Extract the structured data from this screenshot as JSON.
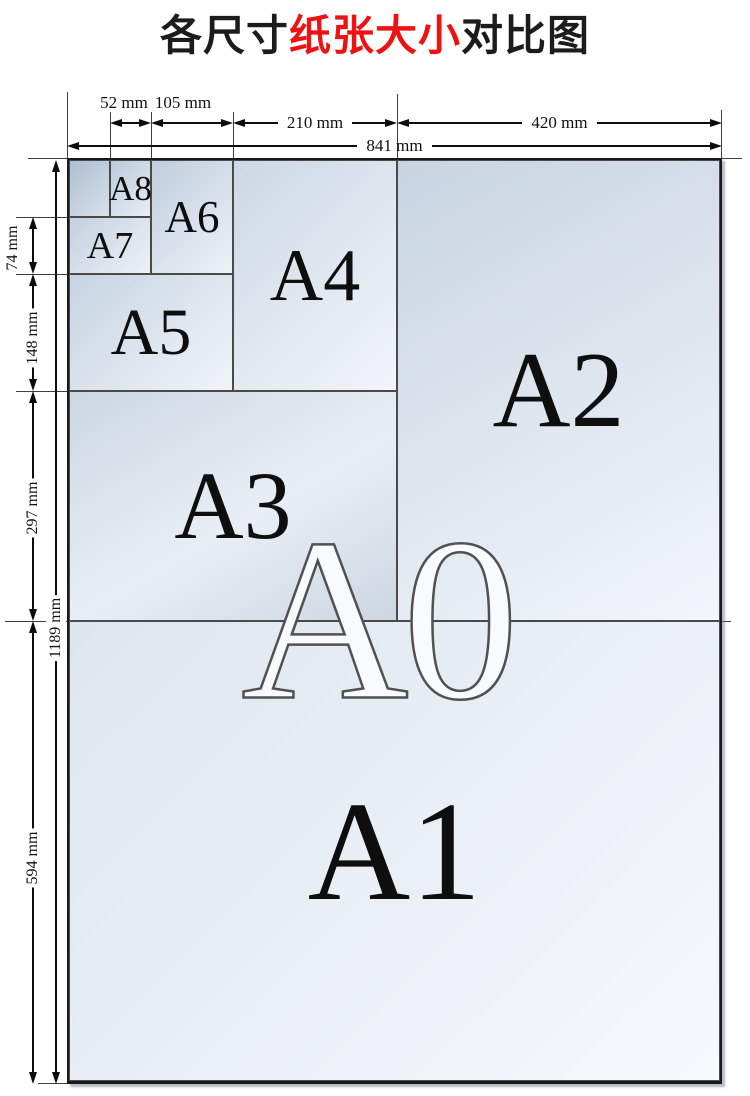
{
  "title": {
    "black_left": "各尺寸",
    "red": "纸张大小",
    "black_right": "对比图"
  },
  "papers": {
    "a0": "A0",
    "a1": "A1",
    "a2": "A2",
    "a3": "A3",
    "a4": "A4",
    "a5": "A5",
    "a6": "A6",
    "a7": "A7",
    "a8": "A8"
  },
  "dimensions": {
    "top": {
      "w52": "52 mm",
      "w105": "105 mm",
      "w210": "210 mm",
      "w420": "420 mm",
      "w841": "841 mm"
    },
    "left": {
      "h74": "74 mm",
      "h148": "148 mm",
      "h297": "297 mm",
      "h594": "594 mm",
      "h1189": "1189 mm"
    }
  },
  "colors": {
    "title_accent": "#ee1212",
    "paper_dark": "#adbed1",
    "paper_light": "#f6f8fc",
    "line": "#0c0c0c"
  }
}
